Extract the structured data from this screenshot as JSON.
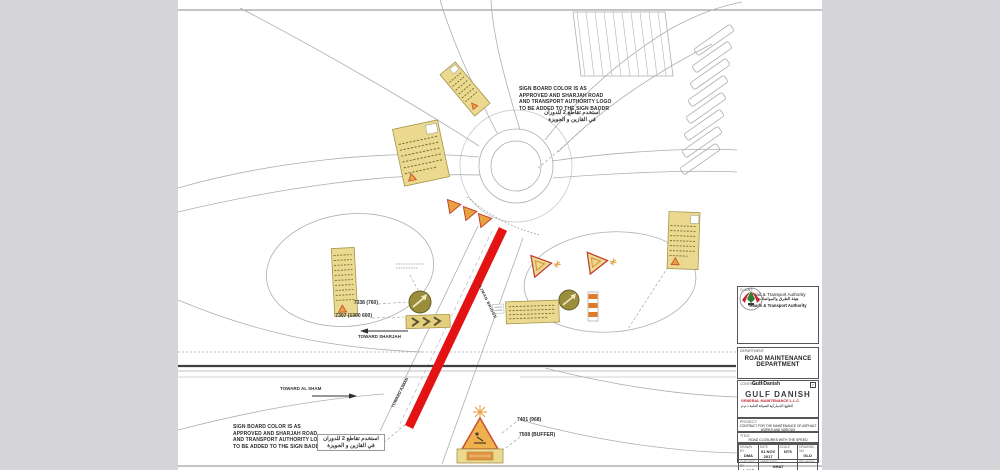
{
  "notes": {
    "sign_board_note": [
      "SIGN BOARD COLOR IS AS",
      "APPROVED AND SHARJAH ROAD",
      "AND TRANSPORT AUTHORITY LOGO",
      "TO BE ADDED TO THE SIGN BAODR"
    ],
    "arabic_note": [
      "استخدم تقاطع 2 للدوران",
      "في القازين و الجويزة"
    ]
  },
  "labels": {
    "toward_sharjah": "TOWARD SHARJAH",
    "toward_al_sham": "TOWARD AL SHAM",
    "toward_ajman": "TOWARD AJMAN",
    "ajman_bridge": "AJMAN BRIDGE",
    "sign_code_1": "7338 (760)",
    "sign_code_2": "7307 (1300 600)",
    "sign_code_3": "7401 (968)",
    "sign_code_4": "7508 (BUFFER)"
  },
  "title_block": {
    "client_label": "CLIENT:",
    "authority_name": "Road & Transport Authority",
    "authority_arabic": "هيئة الطرق والمواصلات",
    "authority_en_bold": "Roads & Transport Authority",
    "department_label": "DEPARTMENT:",
    "department_line1": "ROAD MAINTENANCE",
    "department_line2": "DEPARTMENT",
    "contractor_label": "CONTRACTOR:",
    "contractor_name": "Gulf Danish",
    "company_name": "GULF DANISH",
    "company_sub": "GENERAL MAINTENANCE L.L.C",
    "company_arabic": "الخليج الدنماركية للصيانة العامة ذ.م.م",
    "project_label": "PROJECT:",
    "project_line1": "CONTRACT FOR THE MAINTENANCE OF ASPHALT WORKS AND VARIOUS",
    "project_line2": "IN THE SHARJAH EMIRATE ROADS",
    "title_label": "TITLE:",
    "drawing_title": "ROAD CLOSURES WITH THE SPEED REDUCTION",
    "table": {
      "r1": [
        {
          "h": "DRAWN BY",
          "v": "DMA"
        },
        {
          "h": "DATE",
          "v": "01 NOV 2017"
        },
        {
          "h": "SCALE",
          "v": "NTS"
        },
        {
          "h": "DRAWING NO",
          "v": "GLD"
        }
      ],
      "r2": [
        {
          "h": "CHECKED BY",
          "v": "A CAD"
        },
        {
          "h": "APPROVED",
          "v": "GHAT"
        },
        {
          "h": "REVISION",
          "v": ""
        }
      ]
    }
  }
}
